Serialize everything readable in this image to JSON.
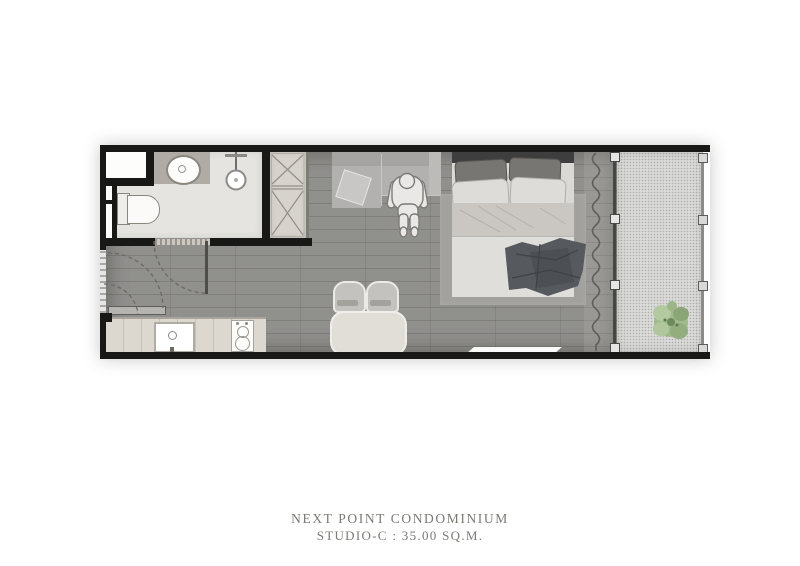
{
  "caption": {
    "line1": "NEXT POINT CONDOMINIUM",
    "line2": "STUDIO-C : 35.00 SQ.M."
  },
  "plan": {
    "unit_type": "STUDIO-C",
    "area_sqm": "35.00",
    "colors": {
      "wall": "#181816",
      "floor": "#8c8b88",
      "bathroom_floor": "#e5e4e0",
      "balcony_floor": "#dbdbd9",
      "kitchen_counter": "#dcd8cf",
      "wardrobe": "#d6d3cc",
      "rug": "#a3a19d",
      "bed_linen": "#dbd9d6",
      "dark_blanket": "#565a5f",
      "sofa": "#b2b1af",
      "table": "#e1ded7",
      "plant": "#a0ba8c",
      "caption_text": "#7c7976"
    },
    "elements": [
      "entrance-door",
      "bathroom",
      "toilet",
      "basin",
      "shower",
      "storage-niche",
      "wardrobe",
      "kitchen-counter",
      "sink",
      "stove",
      "dining-table",
      "dining-chairs",
      "sofa",
      "person-figure",
      "bed",
      "rug",
      "curtain",
      "sliding-glass-door",
      "balcony",
      "balcony-railing",
      "plant"
    ]
  }
}
